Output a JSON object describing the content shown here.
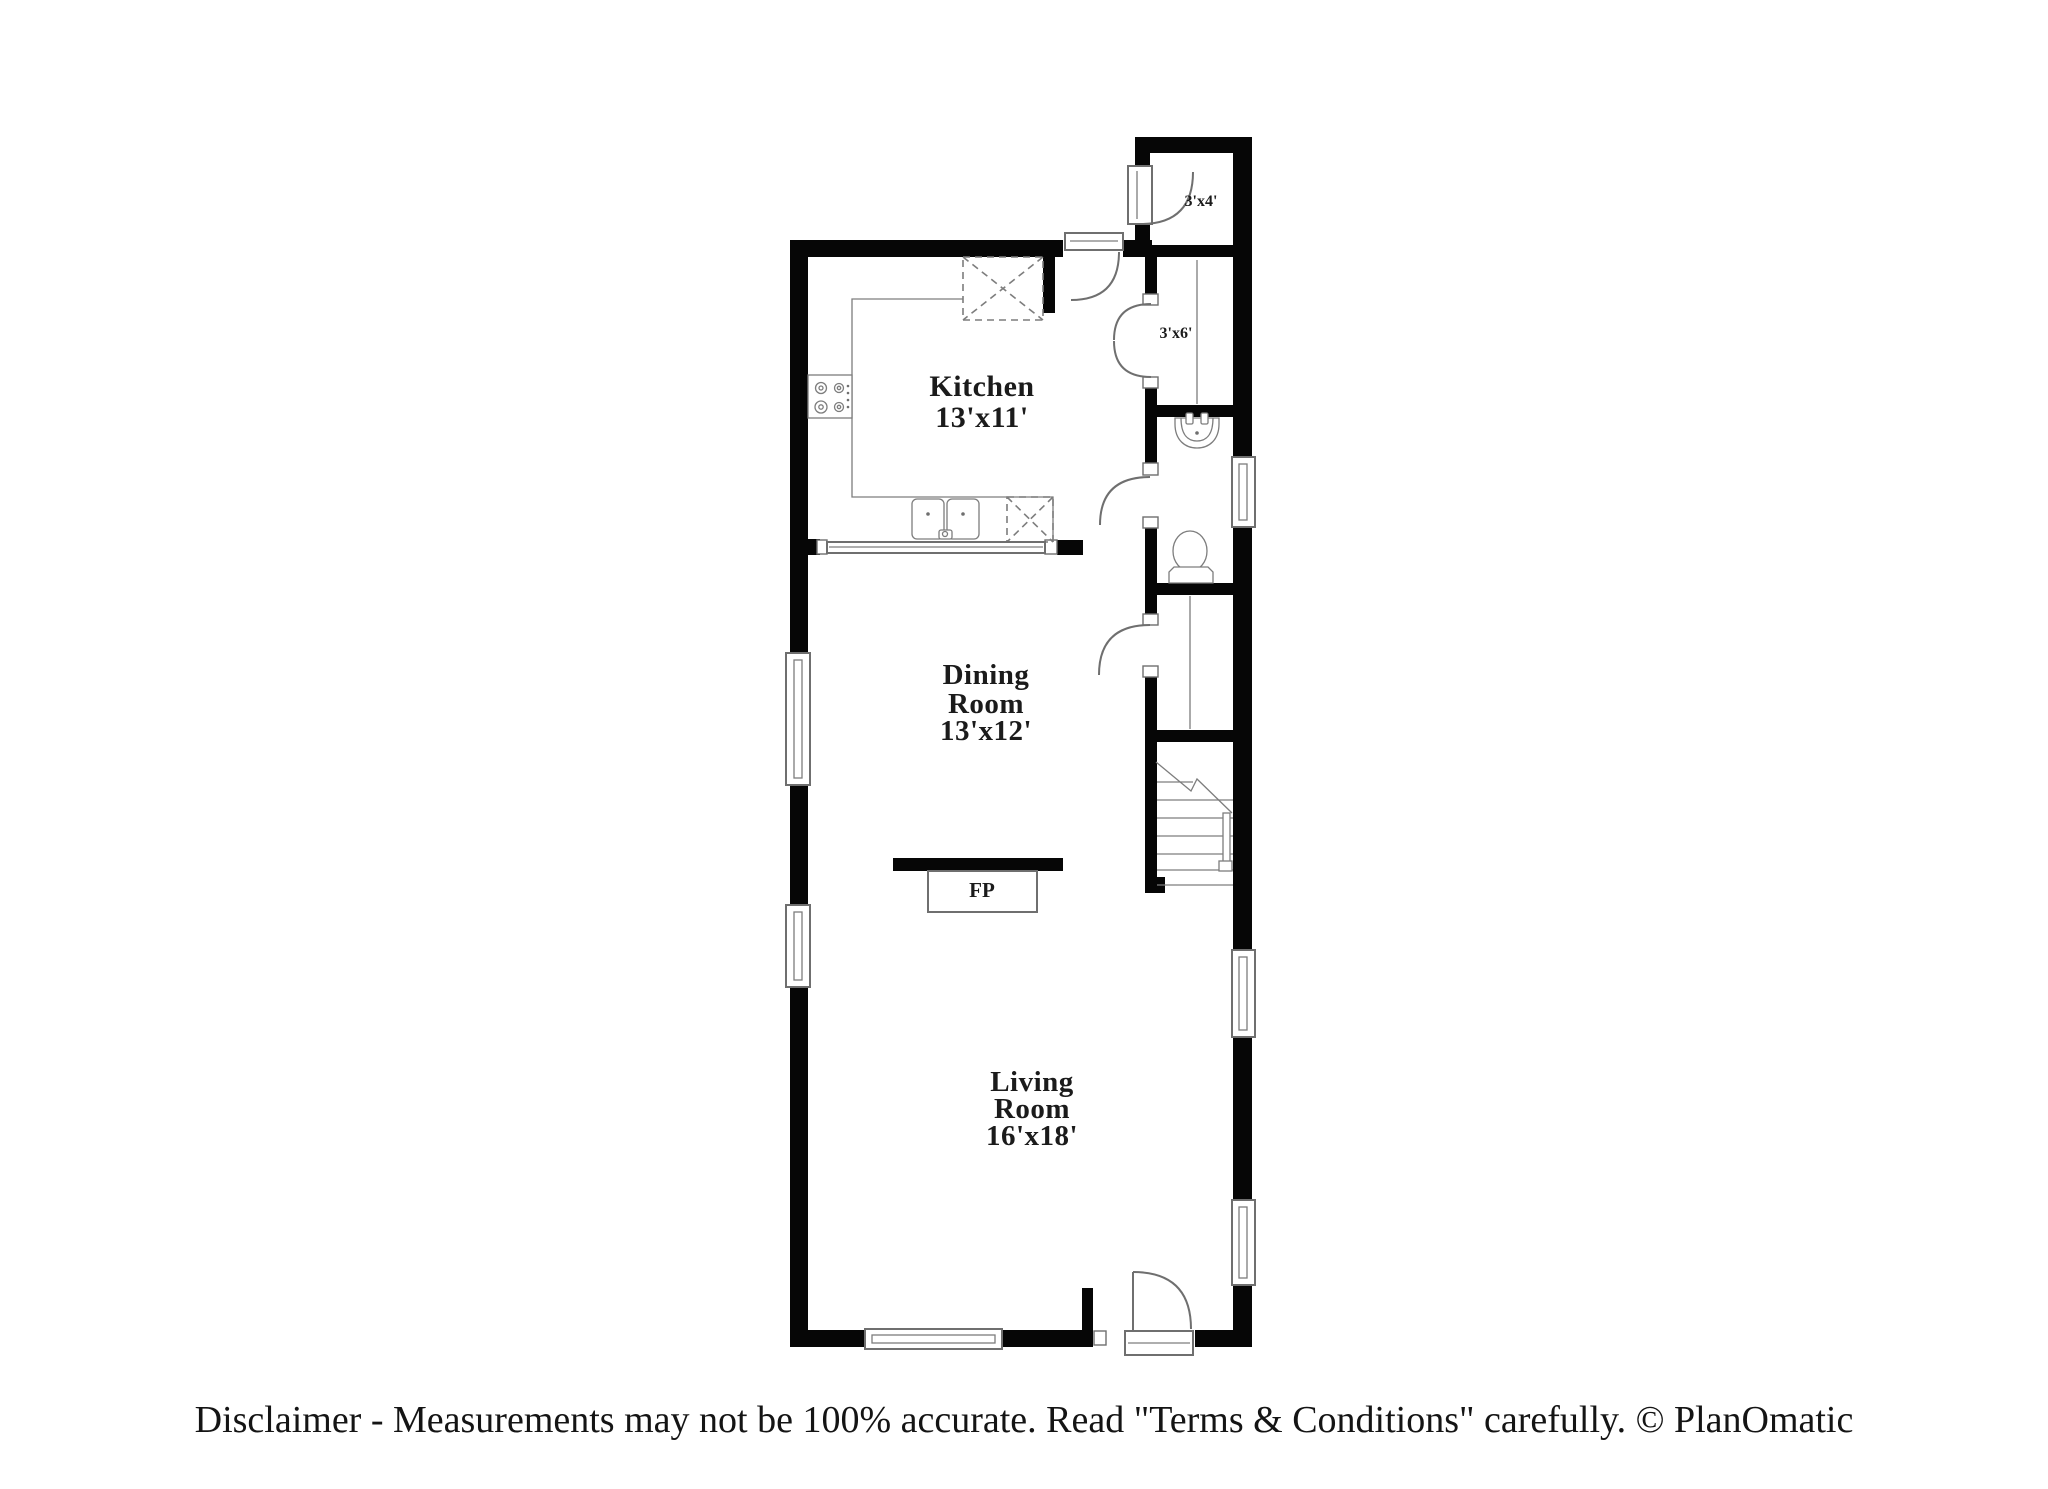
{
  "plan": {
    "rooms": {
      "kitchen": {
        "name": "Kitchen",
        "dims": "13'x11'"
      },
      "dining_room": {
        "name_line1": "Dining",
        "name_line2": "Room",
        "dims": "13'x12'"
      },
      "living_room": {
        "name_line1": "Living",
        "name_line2": "Room",
        "dims": "16'x18'"
      },
      "closet_top": {
        "dims": "3'x4'"
      },
      "closet_hall": {
        "dims": "3'x6'"
      },
      "fireplace": {
        "label": "FP"
      }
    }
  },
  "footer": {
    "disclaimer": "Disclaimer - Measurements may not be 100% accurate. Read \"Terms & Conditions\" carefully. © PlanOmatic"
  },
  "colors": {
    "wall": "#060606",
    "fixture_line": "#6f6f6f",
    "text": "#1b1b1b",
    "background": "#ffffff"
  }
}
